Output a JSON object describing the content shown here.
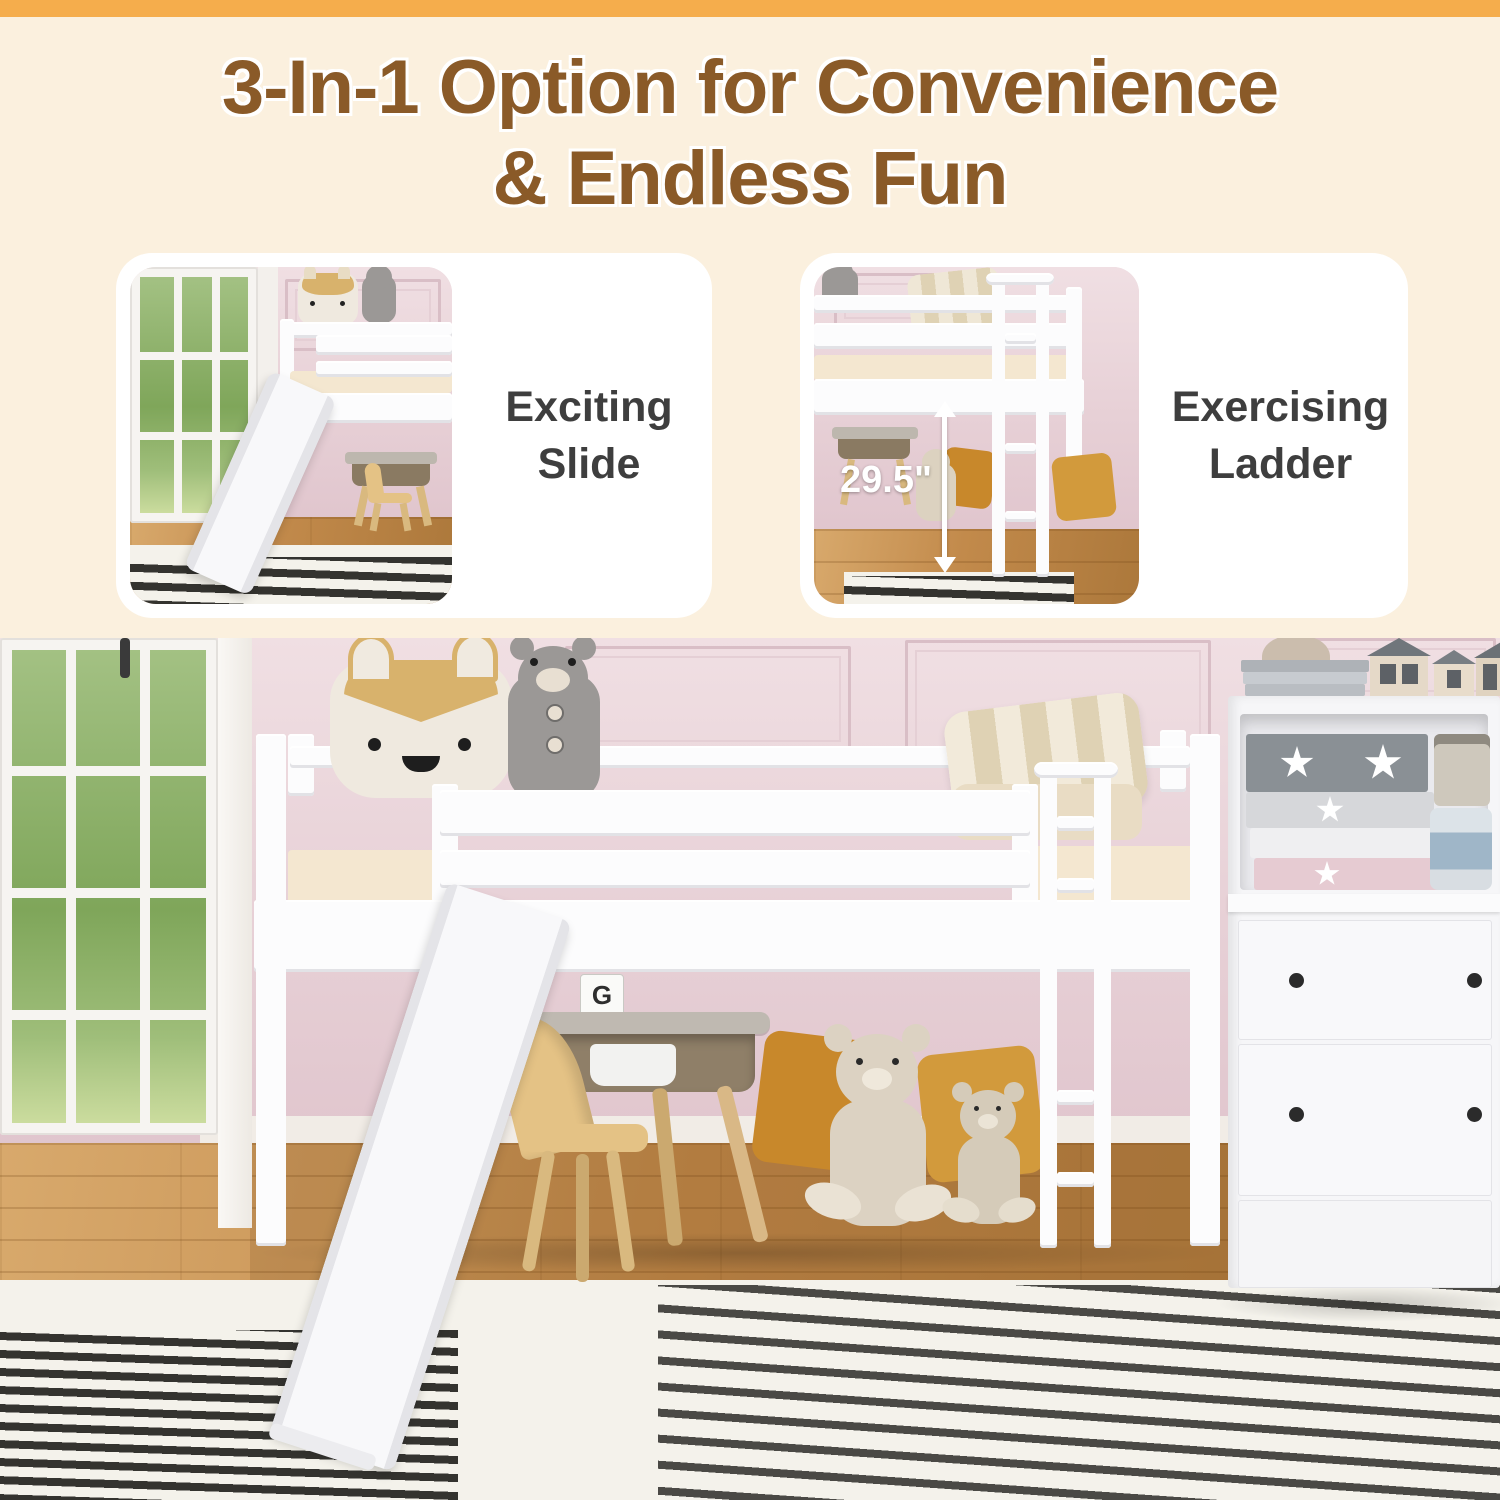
{
  "header": {
    "title_line_1": "3-In-1 Option for Convenience",
    "title_line_2": "& Endless Fun"
  },
  "cards": [
    {
      "id": "exciting-slide",
      "label_line_1": "Exciting",
      "label_line_2": "Slide"
    },
    {
      "id": "exercising-ladder",
      "label_line_1": "Exercising",
      "label_line_2": "Ladder",
      "measurement": "29.5\""
    }
  ],
  "scene": {
    "blocks": {
      "top": "G",
      "left": "K",
      "right": "I"
    }
  },
  "colors": {
    "accent_orange": "#F5AD4C",
    "cream_background": "#FBF0DE",
    "title_brown": "#8A5A28",
    "feature_text": "#3E3E3E",
    "wall_pink": "#E7D0D6",
    "bed_white": "#FCFCFD",
    "mattress_cream": "#F4E7D0",
    "wood_floor": "#C28A4B",
    "mustard_pillow": "#C8882B",
    "rug_stripe_dark": "#34332F",
    "rug_white": "#F4F2EB"
  }
}
